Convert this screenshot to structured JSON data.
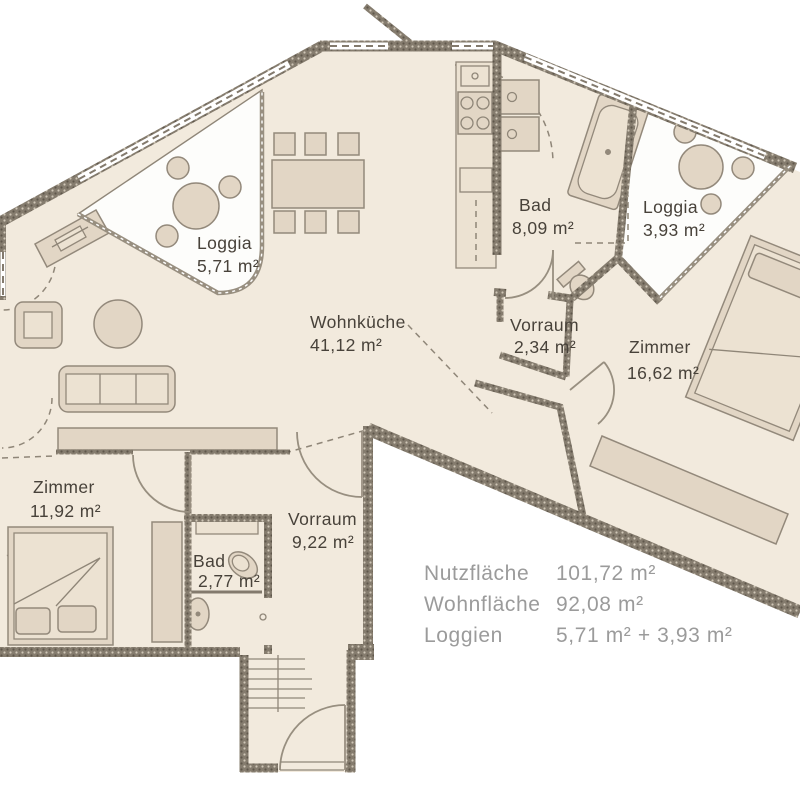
{
  "title": "Wohnung Grundriss",
  "theme": {
    "floor": "#f2eadd",
    "loggia_floor": "#fdfdfb",
    "wall_dark": "#6a6256",
    "wall_mid": "#837a6d",
    "wall_light": "#d9d1c3",
    "furniture_fill": "#e2d6c5",
    "furniture_light": "#ece2d2",
    "furniture_stroke": "#93897b",
    "line": "#8f8678",
    "door": "#988f80",
    "label": "#48423a",
    "legend": "#9b9b9b"
  },
  "rooms": [
    {
      "id": "loggia-west",
      "name": "Loggia",
      "area": "5,71 m²"
    },
    {
      "id": "wohnkueche",
      "name": "Wohnküche",
      "area": "41,12 m²"
    },
    {
      "id": "bad-gross",
      "name": "Bad",
      "area": "8,09 m²"
    },
    {
      "id": "loggia-ost",
      "name": "Loggia",
      "area": "3,93 m²"
    },
    {
      "id": "vorraum-klein",
      "name": "Vorraum",
      "area": "2,34 m²"
    },
    {
      "id": "zimmer-ost",
      "name": "Zimmer",
      "area": "16,62 m²"
    },
    {
      "id": "zimmer-west",
      "name": "Zimmer",
      "area": "11,92 m²"
    },
    {
      "id": "bad-klein",
      "name": "Bad",
      "area": "2,77 m²"
    },
    {
      "id": "vorraum-gross",
      "name": "Vorraum",
      "area": "9,22 m²"
    }
  ],
  "legend": {
    "rows": [
      {
        "label": "Nutzfläche",
        "value": "101,72 m²"
      },
      {
        "label": "Wohnfläche",
        "value": "92,08 m²"
      },
      {
        "label": "Loggien",
        "value": "5,71 m² + 3,93 m²"
      }
    ]
  }
}
